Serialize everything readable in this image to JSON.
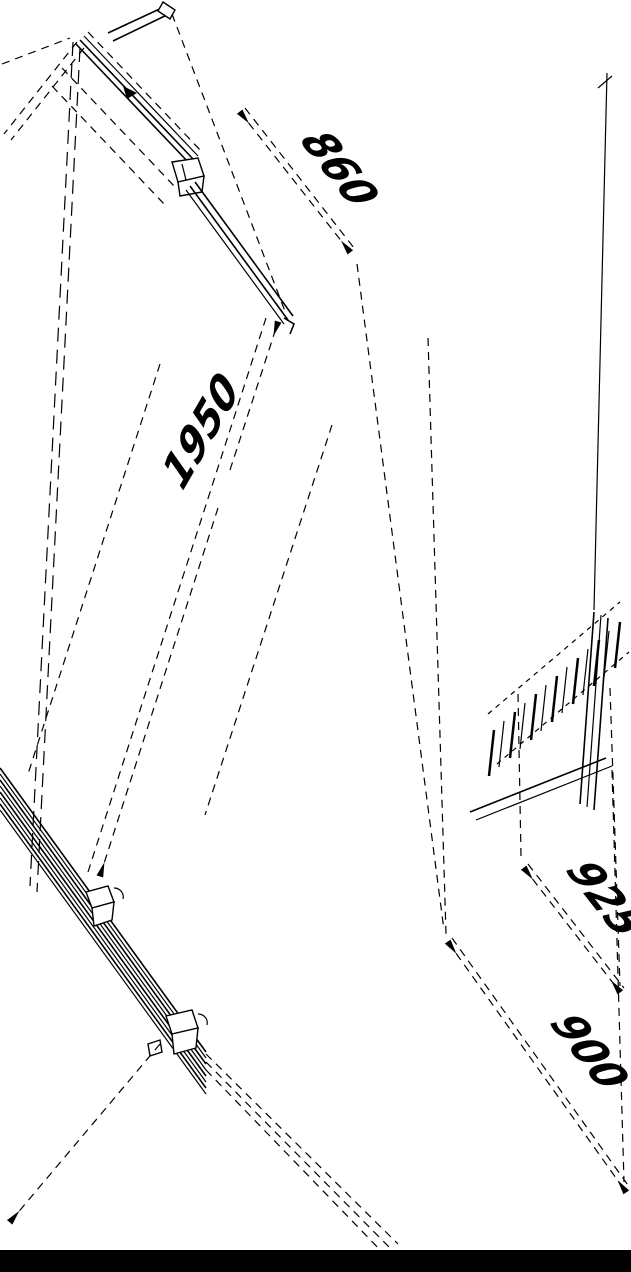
{
  "page": {
    "background": "#ffffff",
    "ink": "#000000",
    "footer_bar_color": "#000000"
  },
  "diagram": {
    "type": "isometric technical line drawing",
    "subject": "glass shower door with wall profiles and side panel, dimensioned CAD view",
    "dimensions": {
      "door_width_top": "860",
      "height": "1950",
      "width_upper_right": "925",
      "width_lower_right": "900"
    }
  }
}
